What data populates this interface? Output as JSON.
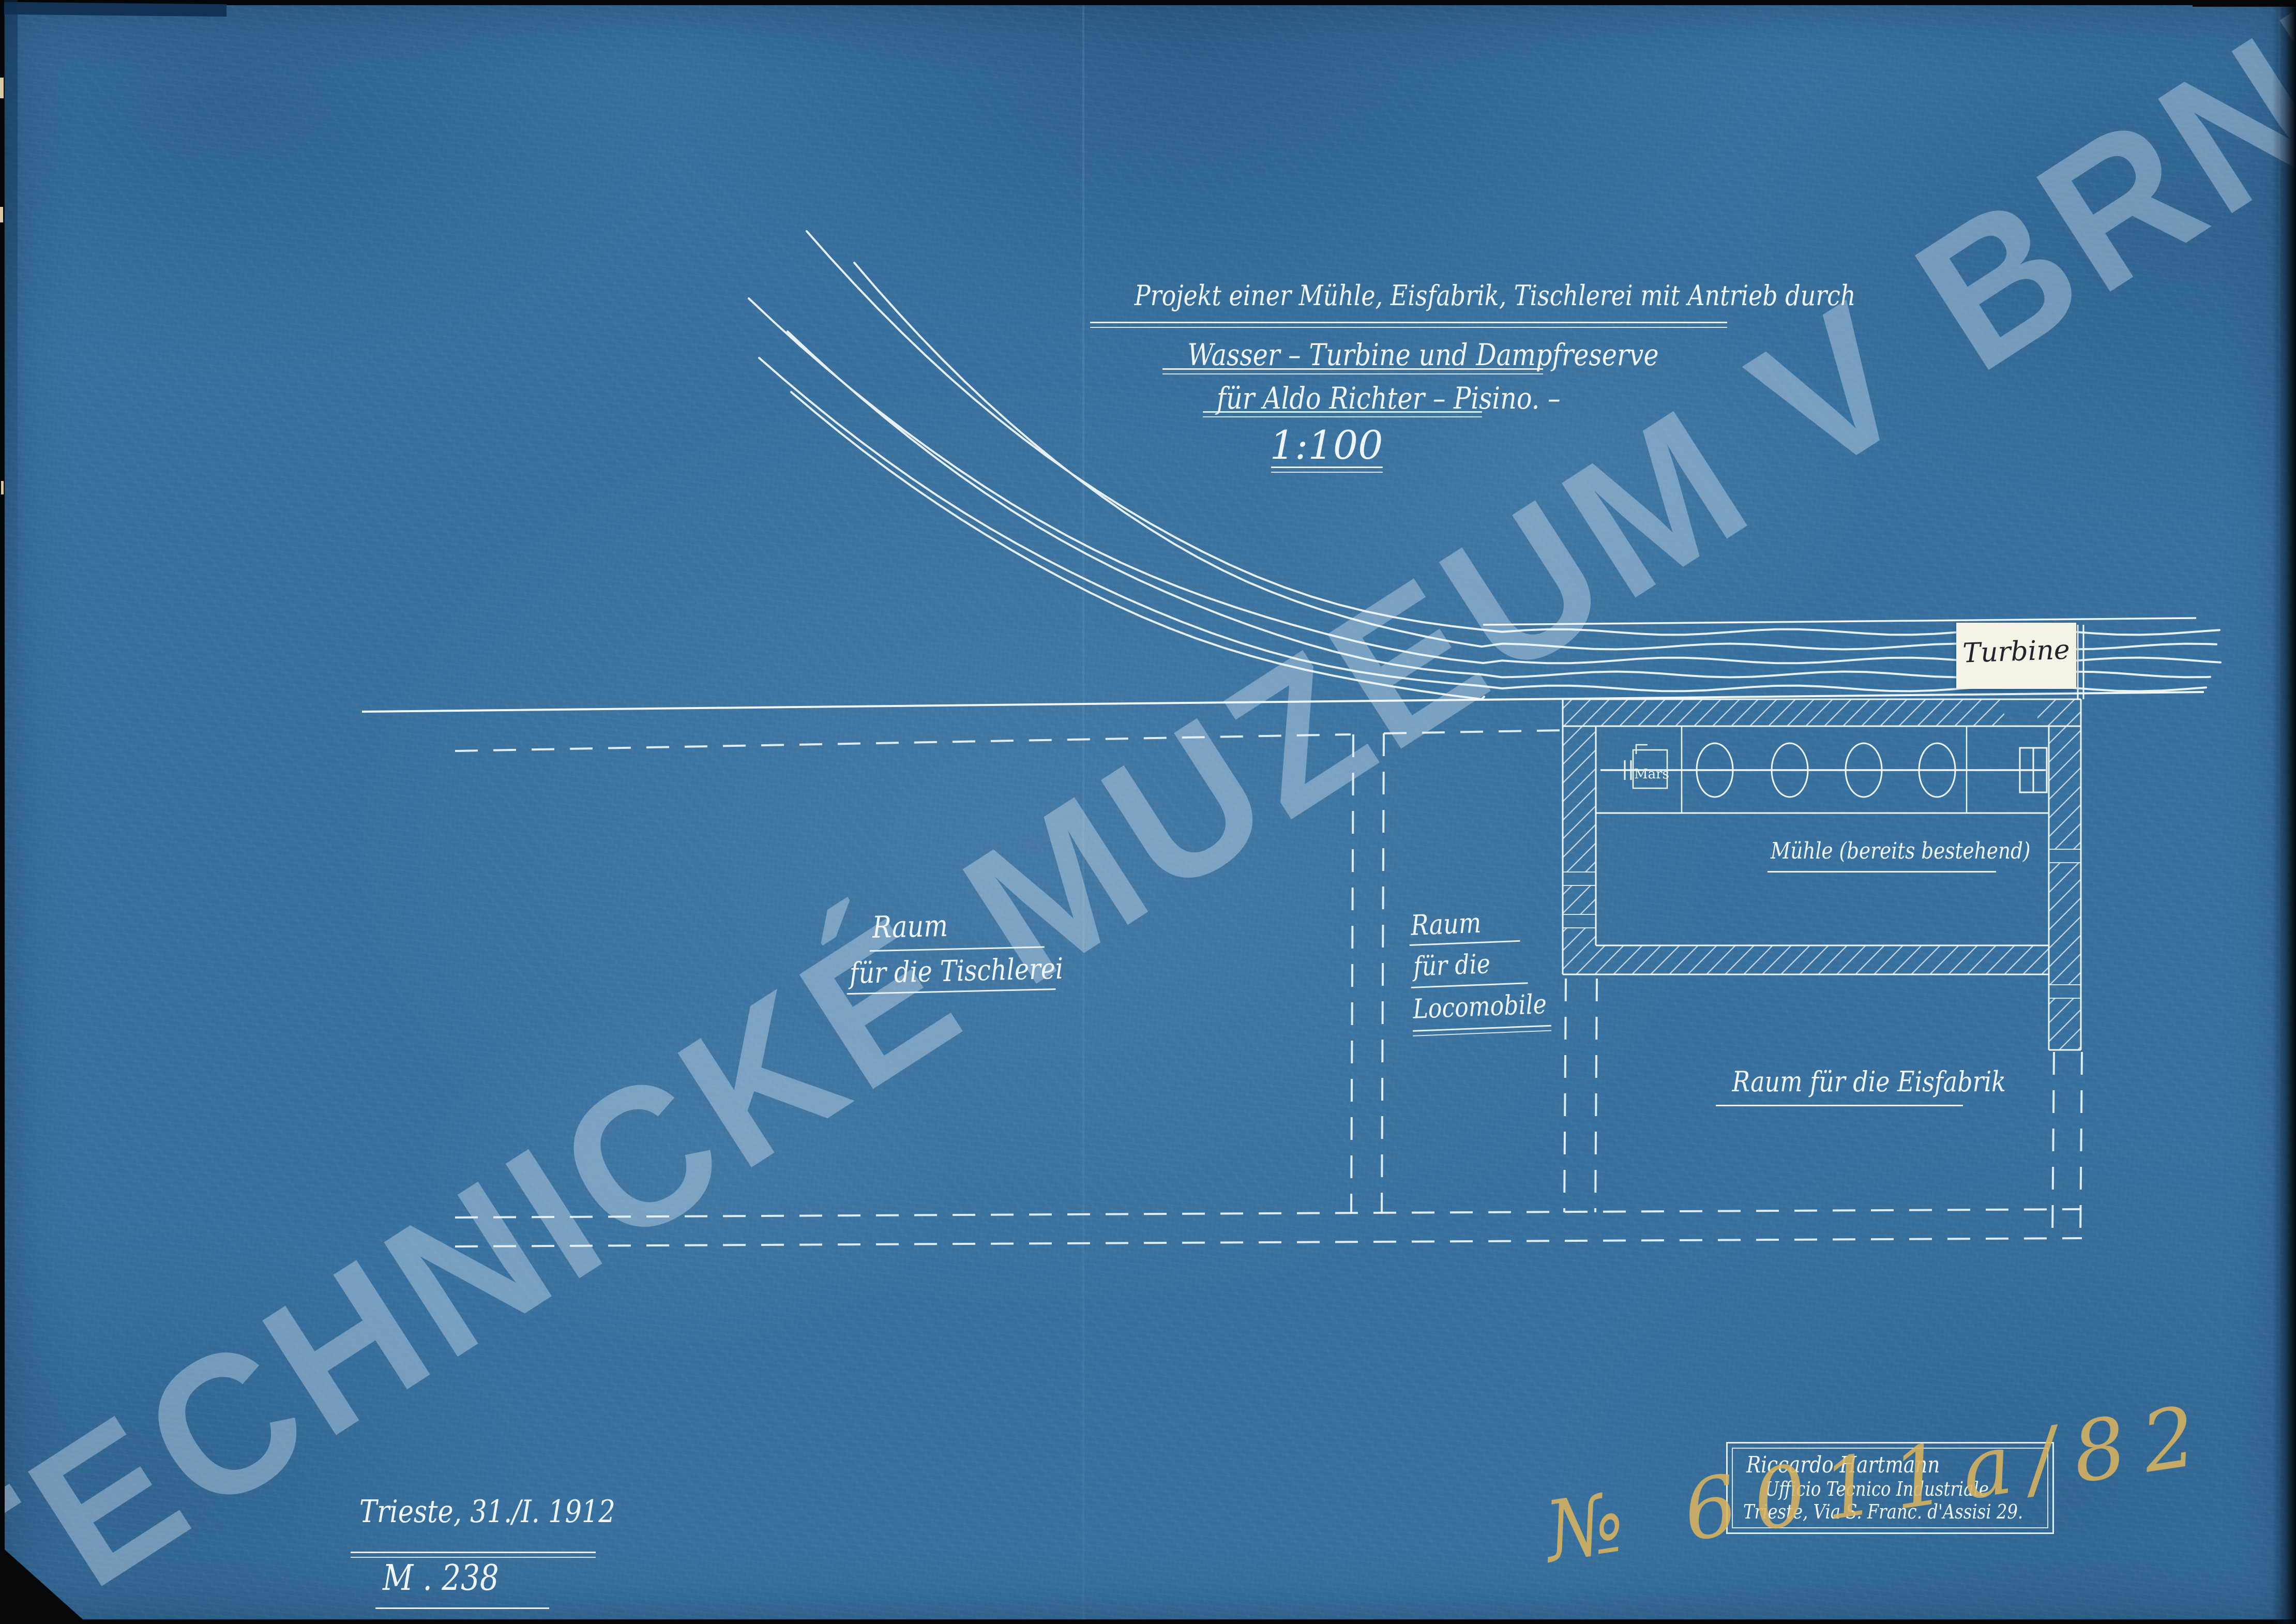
{
  "title": {
    "line1": "Projekt einer Mühle, Eisfabrik, Tischlerei mit Antrieb durch",
    "line2": "Wasser – Turbine und Dampfreserve",
    "line3": "für Aldo Richter – Pisino. –",
    "scale": "1:100"
  },
  "plan": {
    "turbine_label": "Turbine",
    "mill_label": "Mühle (bereits bestehend)",
    "mars_label": "Mars",
    "tischlerei": {
      "line1": "Raum",
      "line2": "für die Tischlerei"
    },
    "locomobile": {
      "line1": "Raum",
      "line2": "für die",
      "line3": "Locomobile"
    },
    "eisfabrik_label": "Raum für die Eisfabrik"
  },
  "footer": {
    "place_date": "Trieste, 31./I. 1912",
    "drawing_number": "M . 238"
  },
  "stamp": {
    "line1": "Riccardo Hartmann",
    "line2": "Ufficio Tecnico Industriale",
    "line3": "Trieste, Via S. Franc. d'Assisi 29."
  },
  "archive": {
    "inventory_number": "№ 6011a/82"
  },
  "watermark": {
    "text": "TECHNICKÉ MUZEUM V BRNĚ"
  },
  "colors": {
    "paper": "#38719f",
    "line": "#eef6fb",
    "ink": "#23232c",
    "pencil": "#d8b35e",
    "label_paper": "#f5f2e8"
  }
}
